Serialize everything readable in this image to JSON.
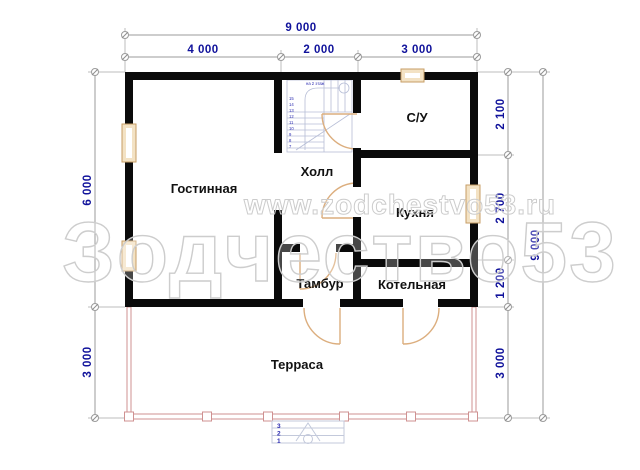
{
  "dimensions": {
    "top_total": "9 000",
    "top_segments": [
      "4 000",
      "2 000",
      "3 000"
    ],
    "left": [
      "6 000",
      "3 000"
    ],
    "right_segments": [
      "2 100",
      "2 700",
      "1 200",
      "3 000"
    ],
    "right_total": "9 000"
  },
  "rooms": {
    "living": {
      "label": "Гостинная"
    },
    "hall": {
      "label": "Холл"
    },
    "bathroom": {
      "label": "С/У"
    },
    "kitchen": {
      "label": "Кухня"
    },
    "vestibule": {
      "label": "Тамбур"
    },
    "boiler": {
      "label": "Котельная"
    },
    "terrace": {
      "label": "Терраса"
    }
  },
  "stairs": {
    "annotation": "на 2 этаж",
    "steps": [
      "15",
      "14",
      "13",
      "12",
      "11",
      "10",
      "9",
      "8",
      "7"
    ]
  },
  "entry_steps": [
    "3",
    "2",
    "1"
  ],
  "watermark": {
    "url": "www.zodchestvo53.ru",
    "brand": "Зодчество53"
  },
  "colors": {
    "wall": "#0a0a0a",
    "dimension_text": "#10129b",
    "dimension_line": "#9b9b9b",
    "window_frame": "#c79e66",
    "window_fill": "#f3e2c4",
    "door": "#dcae7e",
    "terrace_line": "#cf9191",
    "stair_line": "#b6bdd6",
    "watermark": "#cdcdcd"
  }
}
